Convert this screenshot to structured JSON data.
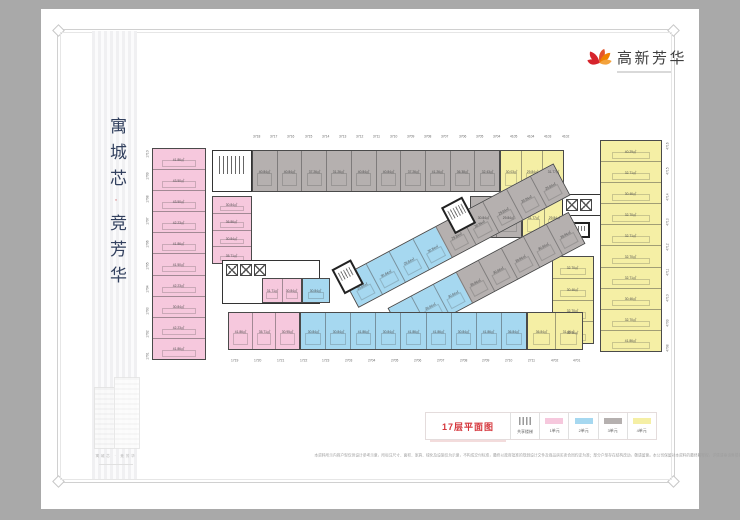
{
  "page_title": {
    "part1": "寓城芯",
    "separator": "·",
    "part2": "竞芳华"
  },
  "logo": {
    "name": "高新芳华"
  },
  "building_caption": "寓城芯 · 竞芳华",
  "legend": {
    "title": "17层平面图",
    "items": [
      {
        "label": "共享楼梯",
        "type": "stairs"
      },
      {
        "label": "1单元",
        "color": "#f6c8dd"
      },
      {
        "label": "2单元",
        "color": "#a6d8f0"
      },
      {
        "label": "3单元",
        "color": "#b5b0af"
      },
      {
        "label": "4单元",
        "color": "#f5efa5"
      }
    ]
  },
  "colors": {
    "unit1_pink": "#f6c8dd",
    "unit2_blue": "#a6d8f0",
    "unit3_gray": "#b5b0af",
    "unit4_yellow": "#f5efa5",
    "accent_red": "#d5363c",
    "title_navy": "#32405e",
    "logo_red": "#d6242c",
    "logo_orange": "#ef8200"
  },
  "plan": {
    "room_numbers": {
      "top": [
        "3718",
        "3717",
        "3716",
        "3715",
        "3714",
        "3713",
        "3712",
        "3711",
        "3710",
        "3709",
        "3708",
        "3707",
        "3706",
        "3705",
        "3704",
        "4105",
        "4104",
        "4103",
        "4102"
      ],
      "bottom": [
        "1719",
        "1720",
        "1721",
        "1722",
        "1723",
        "2703",
        "2704",
        "2705",
        "2706",
        "2707",
        "2708",
        "2709",
        "2710",
        "2711",
        "4702",
        "4701"
      ],
      "left": [
        "1710",
        "1709",
        "1708",
        "1707",
        "1706",
        "1705",
        "1704",
        "1703",
        "1702",
        "1701"
      ],
      "right": [
        "4716",
        "4715",
        "4714",
        "4713",
        "4712",
        "4711",
        "4710",
        "4709",
        "4708"
      ]
    },
    "strips": {
      "left_pink": [
        "41.86㎡",
        "43.50㎡",
        "43.50㎡",
        "42.23㎡",
        "41.86㎡",
        "41.50㎡",
        "42.23㎡",
        "30.84㎡",
        "42.23㎡",
        "41.86㎡"
      ],
      "inner_pink": [
        "30.84㎡",
        "36.86㎡",
        "30.84㎡",
        "35.71㎡"
      ],
      "top_gray": [
        "40.84㎡",
        "40.84㎡",
        "37.26㎡",
        "31.26㎡",
        "40.84㎡",
        "40.84㎡",
        "37.26㎡",
        "41.26㎡",
        "36.38㎡",
        "32.43㎡"
      ],
      "top_yellow": [
        "30.03㎡",
        "29.84㎡",
        "31.77㎡"
      ],
      "gray_row2": [
        "30.84㎡",
        "29.84㎡"
      ],
      "yellow_row2": [
        "31.77㎡",
        "29.84㎡"
      ],
      "right_yellow": [
        "40.29㎡",
        "32.71㎡",
        "30.46㎡",
        "32.70㎡",
        "32.71㎡",
        "32.70㎡",
        "32.71㎡",
        "30.46㎡",
        "32.70㎡",
        "41.86㎡"
      ],
      "inner_yellow": [
        "32.70㎡",
        "30.46㎡",
        "32.70㎡",
        "32.70㎡"
      ],
      "diag_a": [
        {
          "t": "29.84㎡",
          "c": "blue"
        },
        {
          "t": "30.84㎡",
          "c": "blue"
        },
        {
          "t": "29.84㎡",
          "c": "blue"
        },
        {
          "t": "30.84㎡",
          "c": "blue"
        },
        {
          "t": "29.84㎡",
          "c": "gray"
        },
        {
          "t": "30.84㎡",
          "c": "gray"
        },
        {
          "t": "29.84㎡",
          "c": "gray"
        },
        {
          "t": "30.84㎡",
          "c": "gray"
        },
        {
          "t": "29.84㎡",
          "c": "gray"
        }
      ],
      "diag_b": [
        {
          "t": "30.84㎡",
          "c": "blue"
        },
        {
          "t": "29.84㎡",
          "c": "blue"
        },
        {
          "t": "30.84㎡",
          "c": "blue"
        },
        {
          "t": "29.84㎡",
          "c": "gray"
        },
        {
          "t": "30.84㎡",
          "c": "gray"
        },
        {
          "t": "29.84㎡",
          "c": "gray"
        },
        {
          "t": "30.84㎡",
          "c": "gray"
        },
        {
          "t": "29.84㎡",
          "c": "gray"
        }
      ],
      "inner_pink_row": [
        "31.71㎡",
        "30.84㎡"
      ],
      "inner_blue_row": [
        "30.84㎡"
      ],
      "bottom_pink": [
        "41.86㎡",
        "35.71㎡",
        "30.95㎡"
      ],
      "bottom_blue": [
        "30.84㎡",
        "30.84㎡",
        "41.86㎡",
        "30.84㎡",
        "41.86㎡",
        "41.86㎡",
        "30.84㎡",
        "41.86㎡",
        "36.84㎡"
      ],
      "bottom_yellow": [
        "36.84㎡",
        "31.46㎡"
      ]
    }
  },
  "disclaimer": "本资料所示内容户型仅供设计参考示意，所标注尺寸、面积、家具、绿化及设施仅为示意，不构成交付标准，最终以政府批准的规划设计文件及商品房买卖合同约定为准；部分户型存在结构改动，敬请留意。本公司保留对本资料的最终解释权，详情请垂询售楼处。"
}
